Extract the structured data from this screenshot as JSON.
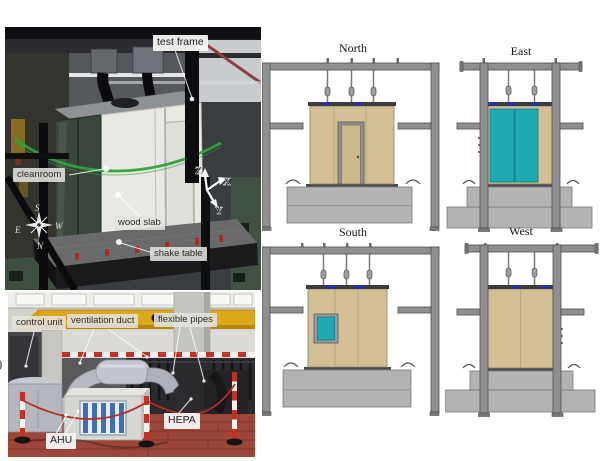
{
  "figure": {
    "photo_top": {
      "labels": {
        "test_frame": "test frame",
        "cleanroom": "cleanroom",
        "wood_slab": "wood slab",
        "shake_table": "shake table"
      },
      "axes": {
        "z": "Z",
        "x": "X",
        "y": "Y"
      },
      "compass": {
        "n": "N",
        "s": "S",
        "e": "E",
        "w": "W"
      }
    },
    "photo_bottom": {
      "labels": {
        "control_unit": "control unit",
        "ventilation_duct": "ventilation duct",
        "flexible_pipes": "flexible pipes",
        "ahu": "AHU",
        "hepa": "HEPA"
      }
    },
    "elevations": {
      "north": "North",
      "east": "East",
      "south": "South",
      "west": "West"
    },
    "edge_fragment": ")",
    "colors": {
      "panel_tan": "#d2c094",
      "glass_teal": "#1faab2",
      "frame_gray": "#8f8f8f",
      "base_gray": "#b3b3b3",
      "connector_blue": "#2430b4",
      "crane_yellow": "#dca81a",
      "brick_floor": "#9c463a"
    }
  }
}
